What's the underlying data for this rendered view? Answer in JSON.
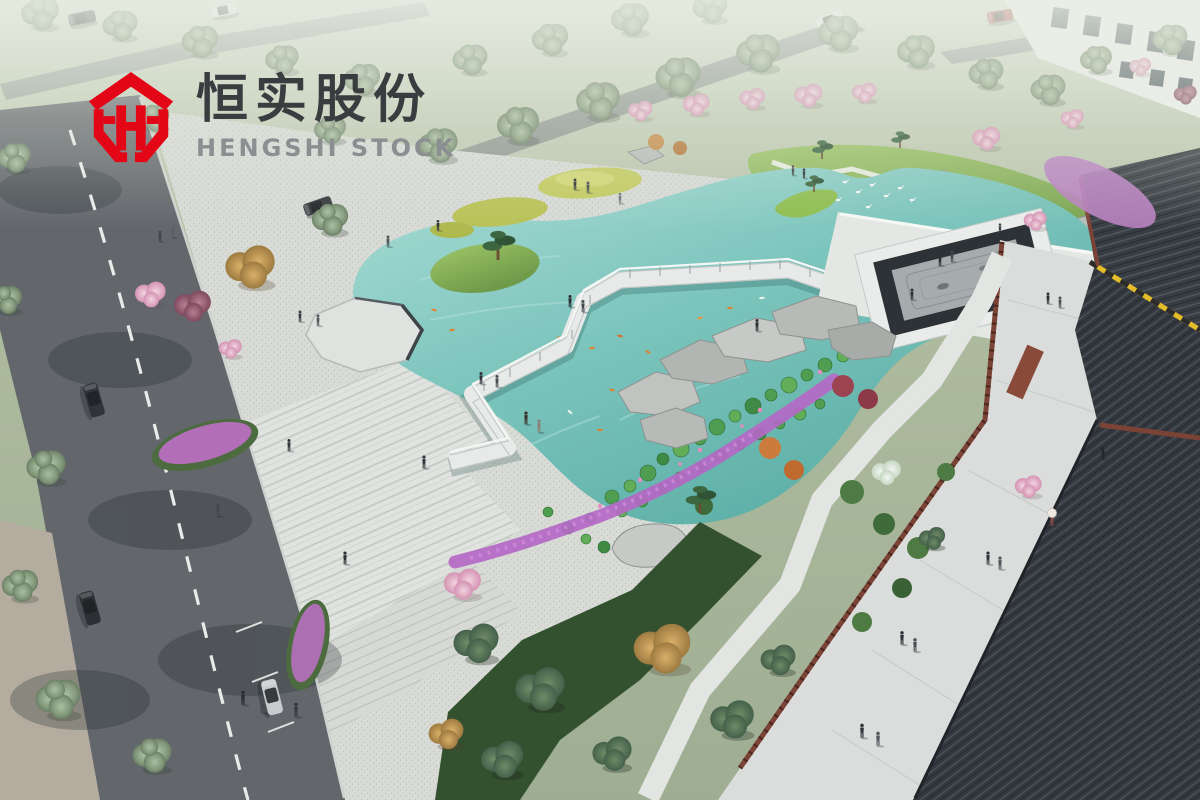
{
  "logo": {
    "cn": "恒实股份",
    "en": "HENGSHI STOCK",
    "emblem": "red-hexagon-H-monogram",
    "brand_red": "#e30616",
    "cn_color": "#3a3d40",
    "en_color": "#8b8f91"
  },
  "scene": {
    "type": "aerial-architectural-rendering",
    "features": [
      "koi-pond",
      "zigzag-boardwalk-bridge",
      "octagon-viewing-deck",
      "zen-gravel-garden",
      "lotus-pads",
      "egrets",
      "cherry-trees",
      "gravel-plaza",
      "striped-stone-paving",
      "city-road-with-cars",
      "traditional-tiled-roofs",
      "red-lattice-fence",
      "white-apartment-building",
      "boulders",
      "flower-beds",
      "pedestrians"
    ]
  },
  "palette": {
    "haze_top": "#d4dccd",
    "field_green": "#a6b49a",
    "road_asphalt": "#63676c",
    "lane_marking": "#eceeec",
    "plaza_light": "#dcdfda",
    "water_shallow": "#a9dcd5",
    "water_deep": "#55aaa1",
    "island_grass": "#8fbe50",
    "lotus_green": "#4f9d50",
    "flower_magenta": "#b468c6",
    "flower_pink": "#e9bccd",
    "shrub_orange": "#cd7a3d",
    "shrub_crimson": "#9c4352",
    "boulder_gray": "#b7bab6",
    "bridge_white": "#e7eae8",
    "zen_frame_dark": "#2d3236",
    "zen_gravel": "#a6abae",
    "roof_dark": "#34393f",
    "fence_red": "#7b4236",
    "hazard_yellow": "#e3bd2a",
    "walkway_light": "#dadddb",
    "car_silver": "#c9ccce",
    "car_dark": "#303439",
    "car_red": "#a33434",
    "car_white": "#e8eae8"
  }
}
